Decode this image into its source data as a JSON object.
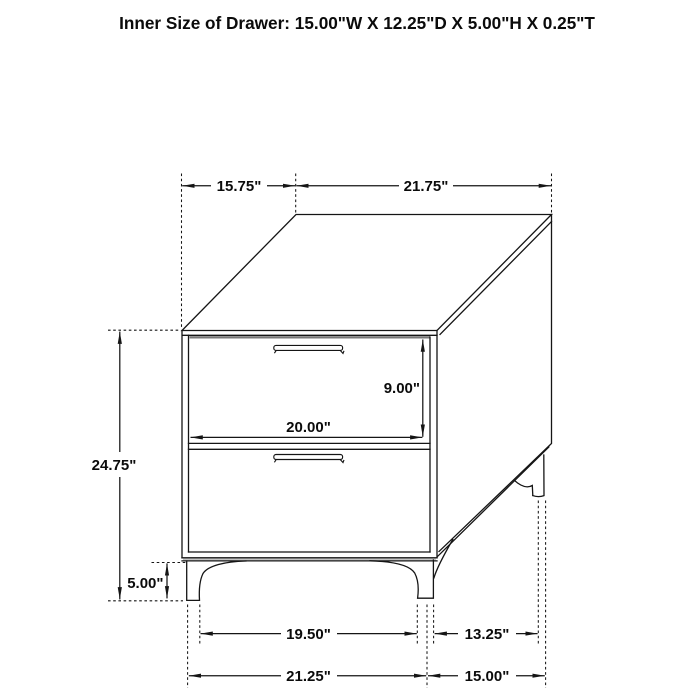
{
  "title": "Inner Size of Drawer: 15.00\"W X 12.25\"D X 5.00\"H X 0.25\"T",
  "diagram": {
    "object": "two-drawer nightstand technical line drawing",
    "drawer_count": 2,
    "style": {
      "line_color": "#151515",
      "background": "#ffffff",
      "top_edge_gray": "#777777",
      "base_edge_gray": "#c4c4c4"
    }
  },
  "dimensions": {
    "top_depth": "15.75\"",
    "top_width": "21.75\"",
    "overall_height": "24.75\"",
    "drawer_front_height": "9.00\"",
    "drawer_front_width": "20.00\"",
    "leg_height": "5.00\"",
    "front_leg_inner_span": "19.50\"",
    "side_leg_span": "13.25\"",
    "front_width_bottom": "21.25\"",
    "side_depth_bottom": "15.00\""
  }
}
